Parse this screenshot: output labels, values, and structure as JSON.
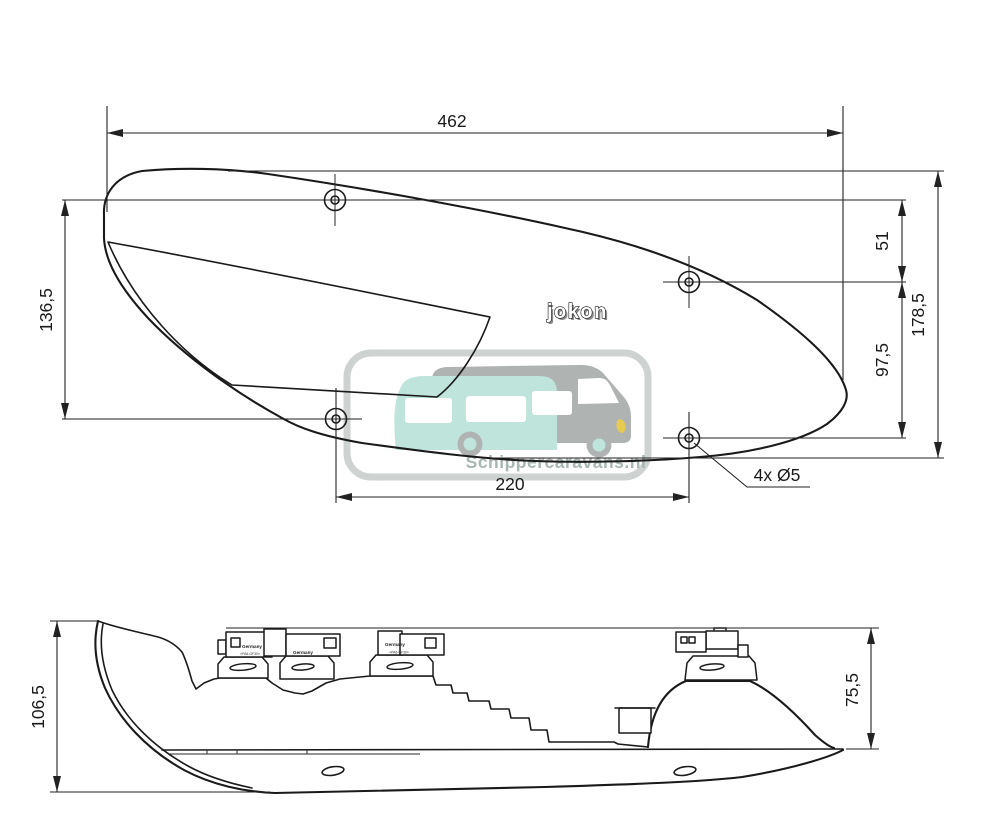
{
  "watermark": {
    "text": "Schippercaravans.nl"
  },
  "brand_logo": {
    "text": "jokon"
  },
  "top_view": {
    "width": "462",
    "left_height": "136,5",
    "hole_offset_top": "51",
    "hole_offset_mid": "97,5",
    "total_height": "178,5",
    "hole_spacing": "220",
    "hole_callout": "4x Ø5"
  },
  "side_view": {
    "total_height": "106,5",
    "body_height": "75,5",
    "connector1_label": "Germany",
    "connector1_material": "«PA6-GF30»",
    "connector2_label": "Germany",
    "connector3_label": "Germany",
    "connector3_material": "«PA6-GF30»"
  },
  "colors": {
    "line": "#1a1a1a",
    "dimension": "#222222",
    "watermark_border": "#c6cbca",
    "watermark_gray": "#a2a6a5",
    "watermark_teal": "#b5e0d5",
    "watermark_yellow": "#e2c235",
    "watermark_text": "#9aaba6"
  }
}
